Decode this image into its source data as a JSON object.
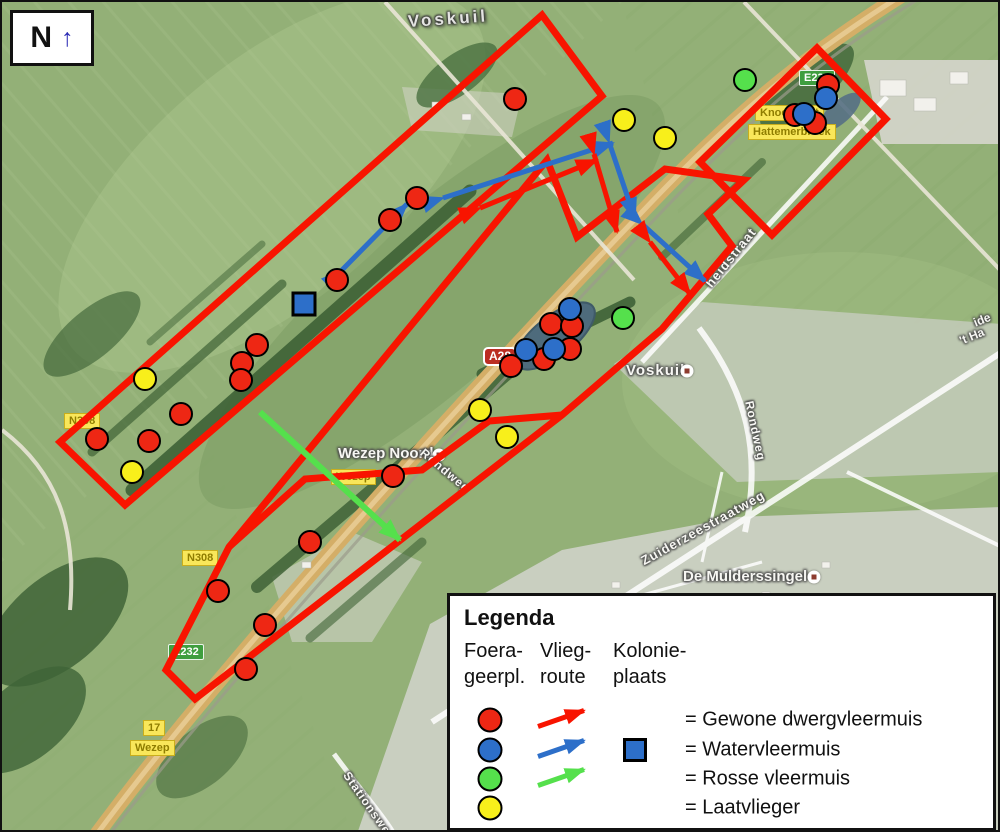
{
  "north_indicator": {
    "letter": "N",
    "arrow": "↑"
  },
  "colors": {
    "red": "#ee2714",
    "blue": "#2d6fc9",
    "green": "#55e04c",
    "yellow": "#f8ef1b",
    "boundary": "#f81400"
  },
  "map": {
    "place_labels": [
      {
        "text": "Voskuil",
        "x": 406,
        "y": 10,
        "rot": -4,
        "size": 17,
        "spacing": 3,
        "big": true
      },
      {
        "text": "Voskuil",
        "x": 624,
        "y": 360,
        "rot": 0,
        "size": 15,
        "spacing": 1,
        "marker": {
          "x": 685,
          "y": 369
        }
      },
      {
        "text": "Wezep Noord",
        "x": 336,
        "y": 443,
        "rot": 0,
        "size": 15,
        "spacing": 0,
        "marker": {
          "x": 437,
          "y": 453
        }
      },
      {
        "text": "De Mulderssingel",
        "x": 681,
        "y": 566,
        "rot": 0,
        "size": 15,
        "spacing": 0,
        "marker": {
          "x": 812,
          "y": 575
        }
      },
      {
        "text": "Rondweg",
        "x": 420,
        "y": 442,
        "rot": 40,
        "size": 12,
        "spacing": 1
      },
      {
        "text": "Rondweg",
        "x": 747,
        "y": 392,
        "rot": 78,
        "size": 12,
        "spacing": 1
      },
      {
        "text": "Zuiderzeestraatweg",
        "x": 640,
        "y": 552,
        "rot": -29,
        "size": 13,
        "spacing": 1
      },
      {
        "text": "heidstraat",
        "x": 706,
        "y": 276,
        "rot": -51,
        "size": 13,
        "spacing": 1
      },
      {
        "text": "Stationsweg",
        "x": 344,
        "y": 764,
        "rot": 55,
        "size": 12,
        "spacing": 1
      },
      {
        "text": "ide",
        "x": 972,
        "y": 314,
        "rot": -22,
        "size": 12,
        "spacing": 0
      },
      {
        "text": "'t Ha",
        "x": 958,
        "y": 332,
        "rot": -22,
        "size": 12,
        "spacing": 0
      }
    ],
    "road_shields": [
      {
        "style": "yellow",
        "text": "N308",
        "x": 62,
        "y": 411
      },
      {
        "style": "yellow",
        "text": "N308",
        "x": 180,
        "y": 548
      },
      {
        "style": "yellow",
        "text": "Wezep",
        "x": 329,
        "y": 467
      },
      {
        "style": "yellow",
        "text": "17",
        "x": 141,
        "y": 718
      },
      {
        "style": "yellow",
        "text": "Wezep",
        "x": 128,
        "y": 738
      },
      {
        "style": "yellow",
        "text": "Knooppunt",
        "x": 753,
        "y": 103
      },
      {
        "style": "yellow",
        "text": "Hattemerbroek",
        "x": 746,
        "y": 122
      },
      {
        "style": "green",
        "text": "E232",
        "x": 166,
        "y": 642
      },
      {
        "style": "green",
        "text": "E232",
        "x": 797,
        "y": 68
      },
      {
        "style": "a28",
        "text": "A28",
        "x": 481,
        "y": 345
      }
    ],
    "survey_area_boundaries": [
      {
        "d": "M 58,440 L 540,13 L 600,94 L 123,503 Z"
      },
      {
        "d": "M 815,46 L 884,117 L 770,233 L 698,160 Z"
      },
      {
        "d": "M 545,158 L 575,235 L 663,167 L 742,178 L 706,212 L 730,244 L 660,327 L 560,413 L 193,697 L 164,668 L 227,545 Z"
      },
      {
        "d": "M 560,413 L 487,419 L 420,468 L 303,477 L 227,545"
      }
    ],
    "flight_routes": [
      {
        "species": "blue",
        "x1": 441,
        "y1": 196,
        "x2": 611,
        "y2": 141,
        "heads": "both"
      },
      {
        "species": "blue",
        "x1": 340,
        "y1": 268,
        "x2": 405,
        "y2": 202,
        "heads": "both"
      },
      {
        "species": "blue",
        "x1": 607,
        "y1": 140,
        "x2": 633,
        "y2": 217,
        "heads": "both"
      },
      {
        "species": "blue",
        "x1": 640,
        "y1": 222,
        "x2": 703,
        "y2": 279,
        "heads": "both"
      },
      {
        "species": "red",
        "x1": 478,
        "y1": 206,
        "x2": 595,
        "y2": 158,
        "heads": "both"
      },
      {
        "species": "red",
        "x1": 592,
        "y1": 152,
        "x2": 615,
        "y2": 230,
        "heads": "both"
      },
      {
        "species": "red",
        "x1": 648,
        "y1": 240,
        "x2": 688,
        "y2": 292,
        "heads": "both"
      },
      {
        "species": "green",
        "x1": 258,
        "y1": 410,
        "x2": 398,
        "y2": 538,
        "heads": "end"
      }
    ],
    "foraging_markers": [
      {
        "species": "red",
        "x": 513,
        "y": 97
      },
      {
        "species": "red",
        "x": 415,
        "y": 196
      },
      {
        "species": "red",
        "x": 388,
        "y": 218
      },
      {
        "species": "red",
        "x": 335,
        "y": 278
      },
      {
        "species": "red",
        "x": 255,
        "y": 343
      },
      {
        "species": "red",
        "x": 240,
        "y": 361
      },
      {
        "species": "red",
        "x": 239,
        "y": 378
      },
      {
        "species": "red",
        "x": 179,
        "y": 412
      },
      {
        "species": "red",
        "x": 95,
        "y": 437
      },
      {
        "species": "red",
        "x": 147,
        "y": 439
      },
      {
        "species": "red",
        "x": 826,
        "y": 83
      },
      {
        "species": "red",
        "x": 793,
        "y": 113
      },
      {
        "species": "red",
        "x": 813,
        "y": 121
      },
      {
        "species": "red",
        "x": 549,
        "y": 322
      },
      {
        "species": "red",
        "x": 570,
        "y": 324
      },
      {
        "species": "red",
        "x": 568,
        "y": 347
      },
      {
        "species": "red",
        "x": 542,
        "y": 357
      },
      {
        "species": "red",
        "x": 509,
        "y": 364
      },
      {
        "species": "red",
        "x": 391,
        "y": 474
      },
      {
        "species": "red",
        "x": 308,
        "y": 540
      },
      {
        "species": "red",
        "x": 216,
        "y": 589
      },
      {
        "species": "red",
        "x": 263,
        "y": 623
      },
      {
        "species": "red",
        "x": 244,
        "y": 667
      },
      {
        "species": "blue",
        "x": 824,
        "y": 96
      },
      {
        "species": "blue",
        "x": 802,
        "y": 112
      },
      {
        "species": "blue",
        "x": 568,
        "y": 307
      },
      {
        "species": "blue",
        "x": 524,
        "y": 348
      },
      {
        "species": "blue",
        "x": 552,
        "y": 347
      },
      {
        "species": "green",
        "x": 743,
        "y": 78
      },
      {
        "species": "green",
        "x": 621,
        "y": 316
      },
      {
        "species": "yellow",
        "x": 622,
        "y": 118
      },
      {
        "species": "yellow",
        "x": 663,
        "y": 136
      },
      {
        "species": "yellow",
        "x": 143,
        "y": 377
      },
      {
        "species": "yellow",
        "x": 130,
        "y": 470
      },
      {
        "species": "yellow",
        "x": 478,
        "y": 408
      },
      {
        "species": "yellow",
        "x": 505,
        "y": 435
      }
    ],
    "colony_marker": {
      "species": "blue",
      "x": 302,
      "y": 302
    }
  },
  "legend": {
    "title": "Legenda",
    "columns": [
      {
        "line1": "Foera-",
        "line2": "geerpl."
      },
      {
        "line1": "Vlieg-",
        "line2": "route"
      },
      {
        "line1": "Kolonie-",
        "line2": "plaats"
      }
    ],
    "rows": [
      {
        "species": "red",
        "has_arrow": true,
        "has_square": false,
        "label": "= Gewone dwergvleermuis"
      },
      {
        "species": "blue",
        "has_arrow": true,
        "has_square": true,
        "label": "= Watervleermuis"
      },
      {
        "species": "green",
        "has_arrow": true,
        "has_square": false,
        "label": "= Rosse vleermuis"
      },
      {
        "species": "yellow",
        "has_arrow": false,
        "has_square": false,
        "label": "= Laatvlieger"
      }
    ]
  }
}
